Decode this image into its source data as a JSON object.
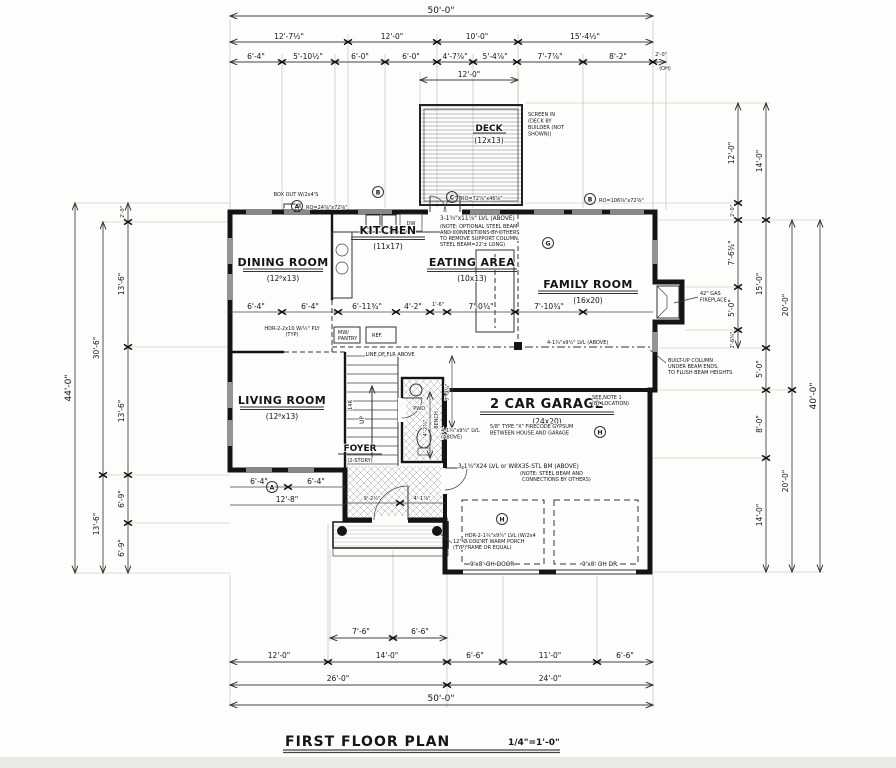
{
  "title_block": {
    "title": "FIRST FLOOR PLAN",
    "scale": "1/4\"=1'-0\""
  },
  "rooms": {
    "dining": {
      "name": "DINING ROOM",
      "size": "(12⁶x13)"
    },
    "kitchen": {
      "name": "KITCHEN",
      "size": "(11x17)"
    },
    "eating": {
      "name": "EATING AREA",
      "size": "(10x13)"
    },
    "family": {
      "name": "FAMILY ROOM",
      "size": "(16x20)"
    },
    "living": {
      "name": "LIVING ROOM",
      "size": "(12⁶x13)"
    },
    "foyer": {
      "name": "FOYER",
      "size": "(2-STORY)"
    },
    "garage": {
      "name": "2 CAR GARAGE",
      "size": "(24x20)"
    },
    "deck": {
      "name": "DECK",
      "size": "(12x13)"
    }
  },
  "dims": {
    "top": {
      "overall": "50'-0\"",
      "row2": [
        "12'-7½\"",
        "12'-0\"",
        "10'-0\"",
        "15'-4½\""
      ],
      "row3": [
        "6'-4\"",
        "5'-10½\"",
        "6'-0\"",
        "6'-0\"",
        "4'-7⅞\"",
        "5'-4⅞\"",
        "7'-7⅞\"",
        "8'-2\"",
        "2'-0\""
      ],
      "oh": "(OH)",
      "deck_width": "12'-0\""
    },
    "bottom": {
      "overall": "50'-0\"",
      "row3": [
        "26'-0\"",
        "24'-0\""
      ],
      "row2": [
        "12'-0\"",
        "14'-0\"",
        "6'-6\"",
        "11'-0\"",
        "6'-6\""
      ],
      "row1": [
        "7'-6\"",
        "6'-6\""
      ]
    },
    "left": {
      "overall": "44'-0\"",
      "col2": [
        "30'-6\"",
        "13'-6\""
      ],
      "col3": [
        "2'-0\"",
        "13'-6\"",
        "13'-6\"",
        "6'-9\"",
        "6'-9\""
      ]
    },
    "right": {
      "overall": "40'-0\"",
      "col1": [
        "12'-0\"",
        "2'-0\"",
        "7'-6¾\"",
        "5'-0\"",
        "2'-6¾\""
      ],
      "col2": [
        "14'-0\"",
        "15'-0\"",
        "5'-0\"",
        "8'-0\"",
        "14'-0\""
      ],
      "col3": [
        "20'-0\"",
        "20'-0\""
      ]
    },
    "interior_mid": [
      "6'-4\"",
      "6'-4\"",
      "6'-11¾\"",
      "4'-2\"",
      "1'-6\"",
      "7'-0¾\"",
      "7'-10¾\""
    ],
    "interior_lower": [
      "6'-4\"",
      "6'-4\"",
      "12'-8\"",
      "9'-2½\"",
      "4'-1⅞\""
    ],
    "foyer_vert": [
      "7'-9¾\"",
      "4'-2¾\""
    ]
  },
  "notes": {
    "deck_note": [
      "SCREEN IN",
      "(DECK BY",
      "BUILDER (NOT",
      "SHOWN))"
    ],
    "beam": [
      "3-1¾\"x11⅞\" LVL (ABOVE)",
      "(NOTE: OPTIONAL STEEL BEAM",
      "AND CONNECTIONS BY OTHERS",
      "TO REMOVE SUPPORT COLUMN.",
      "STEEL BEAM=22'± LONG)"
    ],
    "box_out": "BOX OUT W/2x4'S",
    "fireplace": [
      "42\" GAS",
      "FIREPLACE"
    ],
    "column": [
      "BUILT-UP COLUMN",
      "UNDER BEAM ENDS,",
      "TO FLUSH BEAM HEIGHTS"
    ],
    "lvl_family": "4-1¾\"x9¼\" LVL (ABOVE)",
    "see_note": [
      "SEE NOTE 1",
      "(BY LOCATION)"
    ],
    "gypsum": [
      "5/8\" TYPE \"X\" FIRECODE GYPSUM",
      "BETWEEN HOUSE AND GARAGE"
    ],
    "lvl_garage": [
      "4-1¾\"x9¼\" LVL",
      "(ABOVE)"
    ],
    "steel": [
      "3-1¾\"X24 LVL or W8X35-STL BM (ABOVE)",
      "(NOTE: STEEL BEAM AND",
      "CONNECTIONS BY OTHERS)"
    ],
    "hdr_porch": [
      "HDR-2-1¾\"x9¼\" LVL (W/2x4",
      "SUPPORT WARM PORCH",
      "FRAME OR EQUAL)"
    ],
    "oh_door_l": "9'x8' OH DOOR",
    "oh_door_r": "9'x8' OH DR.",
    "col_typ": [
      "12\" Ø COL.",
      "(TYP)"
    ],
    "hdr_typ": [
      "HDR-2-2x10 W/½\" PLY",
      "(TYP)"
    ],
    "line_above": "LINE OF FLR ABOVE"
  },
  "fixtures": {
    "dw": "DW",
    "ref": "REF.",
    "mw": "MW/",
    "pantry": "PANTRY",
    "bench": "BENCH",
    "up": "UP",
    "stair": "14R",
    "pwd": "PWD."
  },
  "tags": {
    "a": "A",
    "b": "B",
    "c": "C",
    "g": "G",
    "h": "H",
    "win_a": "RO=24⅝\"x72⅝\"",
    "win_b": "RO=106⅝\"x72⅝\"",
    "win_c": "RO=72⅝\"x46⅝\""
  }
}
